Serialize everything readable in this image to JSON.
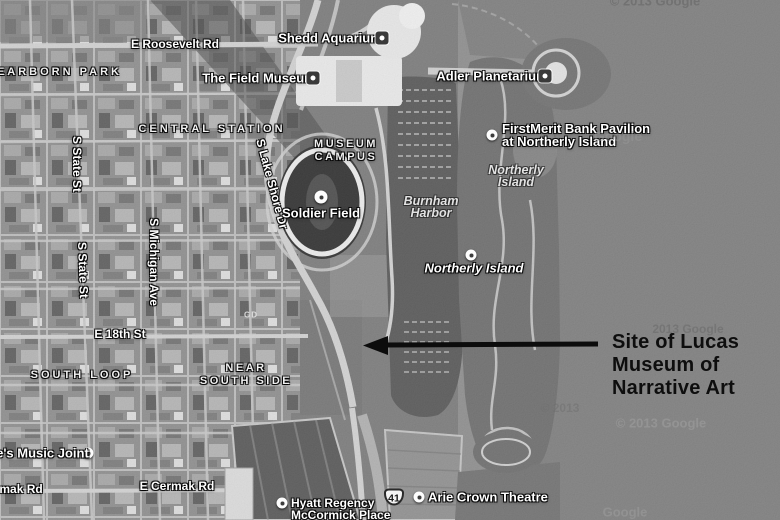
{
  "map_labels": {
    "roads": {
      "roosevelt": "E Roosevelt Rd",
      "eighteenth": "E 18th St",
      "cermak": "E Cermak Rd",
      "cermak_partial": "E Cermak Rd",
      "state_north": "S State St",
      "state_south": "S State St",
      "michigan": "S Michigan Ave",
      "lake_shore": "S Lake Shore Dr"
    },
    "areas": {
      "dearborn_park": "DEARBORN PARK",
      "central_station": "CENTRAL STATION",
      "museum_campus_line1": "MUSEUM",
      "museum_campus_line2": "CAMPUS",
      "south_loop": "SOUTH LOOP",
      "near_south_side_line1": "NEAR",
      "near_south_side_line2": "SOUTH SIDE"
    },
    "water": {
      "burnham_line1": "Burnham",
      "burnham_line2": "Harbor",
      "northerly_area_line1": "Northerly",
      "northerly_area_line2": "Island"
    },
    "pois": {
      "shedd": "Shedd Aquarium",
      "field_museum": "The Field Museum",
      "adler": "Adler Planetarium",
      "firstmerit_line1": "FirstMerit Bank Pavilion",
      "firstmerit_line2": "at Northerly Island",
      "soldier_field": "Soldier Field",
      "northerly_island": "Northerly Island",
      "arie_crown": "Arie Crown Theatre",
      "hyatt_line1": "Hyatt Regency",
      "hyatt_line2": "McCormick Place",
      "reggies": "Reggie's Music Joint",
      "rooftop_text": "GD"
    },
    "shield": "41"
  },
  "annotation": {
    "line1": "Site of Lucas",
    "line2": "Museum of",
    "line3": "Narrative Art"
  },
  "watermarks": {
    "top_right": "© 2013 Google",
    "mid_right": "Google",
    "right": "2013 Google",
    "center": "© 2013",
    "lower_right": "© 2013 Google",
    "bottom_right": "Google"
  },
  "colors": {
    "water": "#7d7d7d",
    "harbor": "#565656",
    "city_base": "#8d8d8d",
    "park": "#7a7a7a",
    "label": "#ffffff",
    "annotation_text": "#0e0e0e",
    "arrow": "#0c0c0c"
  }
}
